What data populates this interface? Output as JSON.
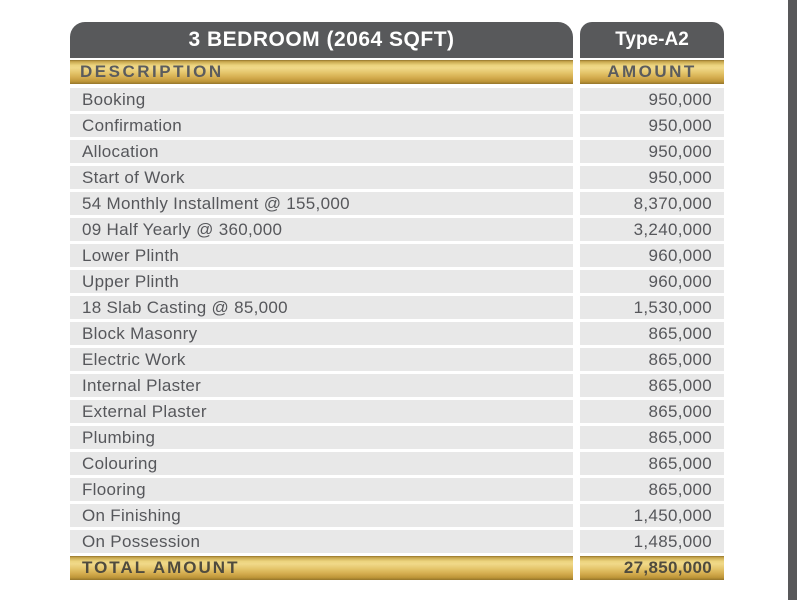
{
  "table": {
    "title": "3 BEDROOM (2064 SQFT)",
    "type_label": "Type-A2",
    "columns": {
      "description": "DESCRIPTION",
      "amount": "AMOUNT"
    },
    "rows": [
      {
        "description": "Booking",
        "amount": "950,000"
      },
      {
        "description": "Confirmation",
        "amount": "950,000"
      },
      {
        "description": "Allocation",
        "amount": "950,000"
      },
      {
        "description": "Start of Work",
        "amount": "950,000"
      },
      {
        "description": "54 Monthly Installment @ 155,000",
        "amount": "8,370,000"
      },
      {
        "description": "09 Half Yearly @ 360,000",
        "amount": "3,240,000"
      },
      {
        "description": "Lower Plinth",
        "amount": "960,000"
      },
      {
        "description": "Upper Plinth",
        "amount": "960,000"
      },
      {
        "description": "18 Slab Casting @ 85,000",
        "amount": "1,530,000"
      },
      {
        "description": "Block Masonry",
        "amount": "865,000"
      },
      {
        "description": "Electric Work",
        "amount": "865,000"
      },
      {
        "description": "Internal Plaster",
        "amount": "865,000"
      },
      {
        "description": "External Plaster",
        "amount": "865,000"
      },
      {
        "description": "Plumbing",
        "amount": "865,000"
      },
      {
        "description": "Colouring",
        "amount": "865,000"
      },
      {
        "description": "Flooring",
        "amount": "865,000"
      },
      {
        "description": "On Finishing",
        "amount": "1,450,000"
      },
      {
        "description": "On Possession",
        "amount": "1,485,000"
      }
    ],
    "total": {
      "label": "TOTAL AMOUNT",
      "amount": "27,850,000"
    }
  },
  "colors": {
    "header_gray": "#58595b",
    "gold_light": "#f0d989",
    "gold_dark": "#93742a",
    "row_gray": "#e8e8e8",
    "body_text": "#56575b",
    "right_strip": "#58585a"
  }
}
